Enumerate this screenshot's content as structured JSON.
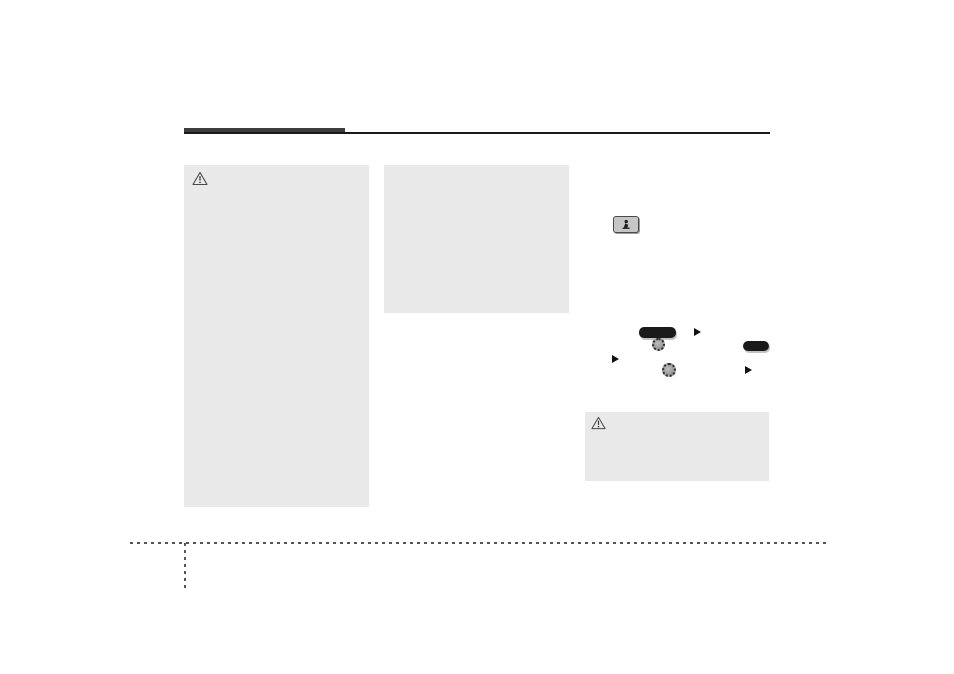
{
  "page": {
    "type": "owners-manual-page",
    "background_color": "#ffffff",
    "visible_text": ""
  },
  "header": {
    "accent_bar_color": "#3d3d3d",
    "line_color": "#1a1a1a"
  },
  "boxes": {
    "left_caution": {
      "fill": "#e9e9e9",
      "icon": "warning-triangle-icon",
      "text": ""
    },
    "middle_note": {
      "fill": "#e9e9e9",
      "text": ""
    },
    "right_caution": {
      "fill": "#e9e9e9",
      "icon": "warning-triangle-icon",
      "text": ""
    }
  },
  "controls_illustration": {
    "remote_button": {
      "icon": "steering-remote-button-icon",
      "fill": "#c6c6c6",
      "border": "#4a4a4a"
    },
    "pill_button_color": "#1a1a1a",
    "knob_color": "#8a8a8a",
    "arrow_color": "#111111",
    "items": [
      "pill-button-large",
      "arrow-right-icon",
      "rotary-knob-icon",
      "pill-button-small",
      "arrow-right-icon",
      "rotary-knob-icon",
      "arrow-right-icon"
    ]
  },
  "footer": {
    "dash_color": "#555555",
    "lines": [
      "horizontal-dashed-line",
      "vertical-dashed-line"
    ]
  },
  "aria": {
    "warning": "warning-triangle-icon",
    "remote_button": "steering-remote-button-icon",
    "knob": "rotary-knob-icon",
    "arrow": "arrow-right-icon"
  }
}
